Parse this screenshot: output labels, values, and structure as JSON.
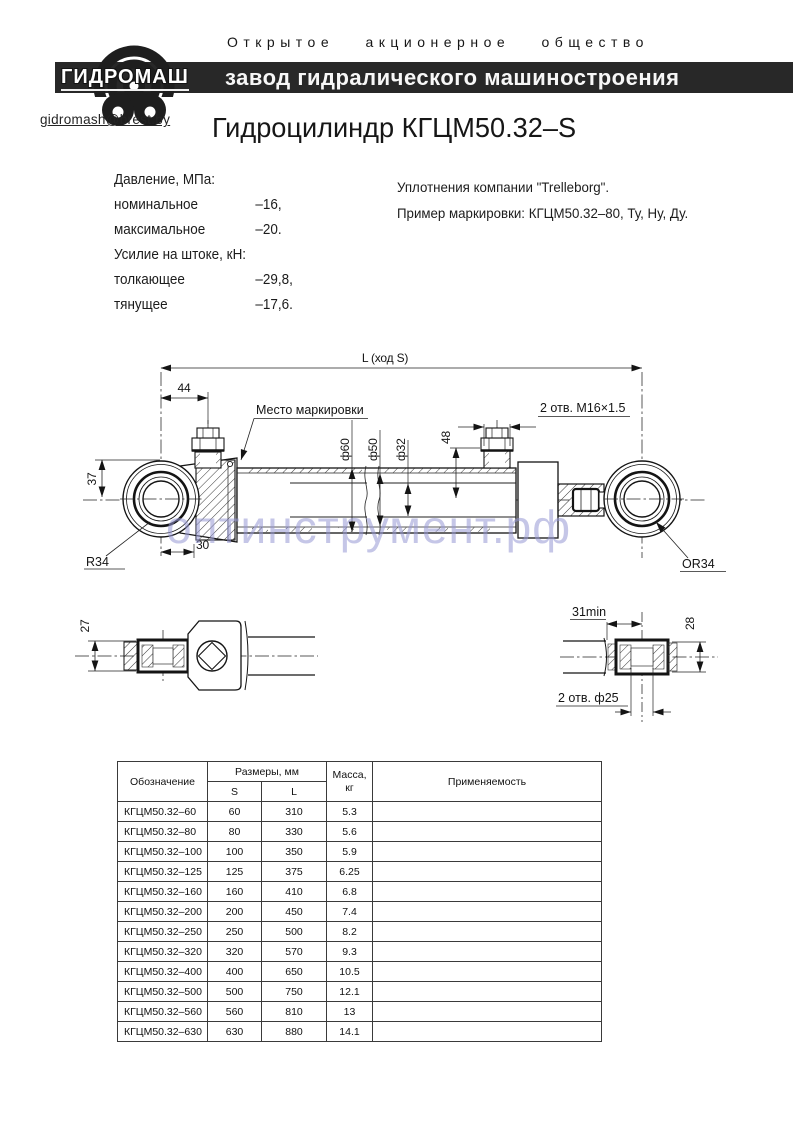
{
  "header": {
    "org_type": "Открытое акционерное общество",
    "banner": "завод гидралического машиностроения",
    "logo": "ГИДРОМАШ",
    "email": "gidromash@brest.by"
  },
  "title": "Гидроцилиндр КГЦМ50.32–S",
  "specs": {
    "rows": [
      {
        "label": "Давление, МПа:",
        "value": ""
      },
      {
        "label": "номинальное",
        "value": "–16,"
      },
      {
        "label": "максимальное",
        "value": "–20."
      },
      {
        "label": "Усилие на штоке, кН:",
        "value": ""
      },
      {
        "label": "толкающее",
        "value": "–29,8,"
      },
      {
        "label": "тянущее",
        "value": "–17,6."
      }
    ],
    "notes": [
      "Уплотнения компании \"Trelleborg\".",
      "Пример маркировки: КГЦМ50.32–80, Ту, Ну, Ду."
    ]
  },
  "drawing": {
    "dim_total": "L (ход S)",
    "dim_44": "44",
    "dim_37": "37",
    "dim_30": "30",
    "radius_left": "R34",
    "marking_label": "Место маркировки",
    "dia_60": "ф60",
    "dia_50": "ф50",
    "dia_32": "ф32",
    "dim_48": "48",
    "ports_label": "2 отв. М16×1.5",
    "radius_right": "ОR34",
    "detail_left": {
      "dim_27": "27"
    },
    "detail_right": {
      "dim_31": "31min",
      "dim_28": "28",
      "holes_label": "2 отв. ф25"
    }
  },
  "watermark": "оптинструмент.рф",
  "table": {
    "col_designation": "Обозначение",
    "col_sizes": "Размеры, мм",
    "col_s": "S",
    "col_l": "L",
    "col_mass": "Масса, кг",
    "col_app": "Применяемость",
    "rows": [
      {
        "name": "КГЦМ50.32–60",
        "s": "60",
        "l": "310",
        "m": "5.3",
        "app": ""
      },
      {
        "name": "КГЦМ50.32–80",
        "s": "80",
        "l": "330",
        "m": "5.6",
        "app": ""
      },
      {
        "name": "КГЦМ50.32–100",
        "s": "100",
        "l": "350",
        "m": "5.9",
        "app": ""
      },
      {
        "name": "КГЦМ50.32–125",
        "s": "125",
        "l": "375",
        "m": "6.25",
        "app": ""
      },
      {
        "name": "КГЦМ50.32–160",
        "s": "160",
        "l": "410",
        "m": "6.8",
        "app": ""
      },
      {
        "name": "КГЦМ50.32–200",
        "s": "200",
        "l": "450",
        "m": "7.4",
        "app": ""
      },
      {
        "name": "КГЦМ50.32–250",
        "s": "250",
        "l": "500",
        "m": "8.2",
        "app": ""
      },
      {
        "name": "КГЦМ50.32–320",
        "s": "320",
        "l": "570",
        "m": "9.3",
        "app": ""
      },
      {
        "name": "КГЦМ50.32–400",
        "s": "400",
        "l": "650",
        "m": "10.5",
        "app": ""
      },
      {
        "name": "КГЦМ50.32–500",
        "s": "500",
        "l": "750",
        "m": "12.1",
        "app": ""
      },
      {
        "name": "КГЦМ50.32–560",
        "s": "560",
        "l": "810",
        "m": "13",
        "app": ""
      },
      {
        "name": "КГЦМ50.32–630",
        "s": "630",
        "l": "880",
        "m": "14.1",
        "app": ""
      }
    ]
  }
}
